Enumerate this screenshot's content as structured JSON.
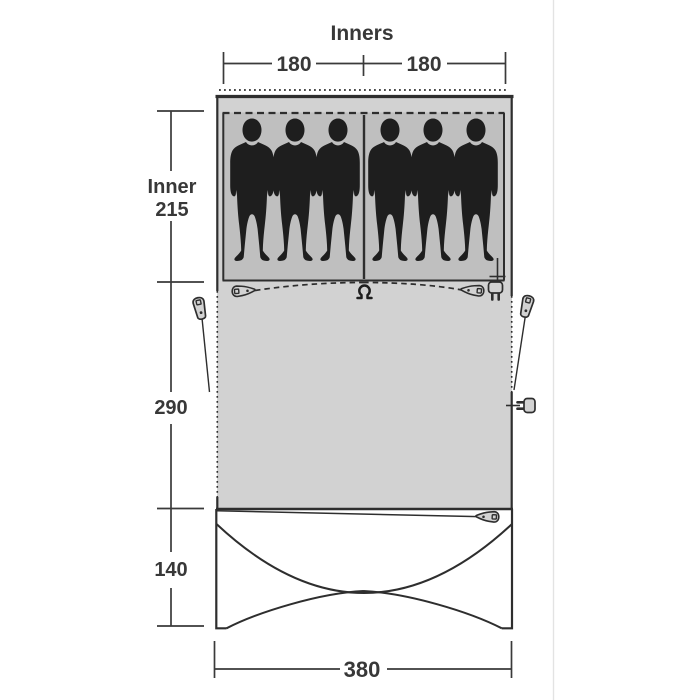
{
  "diagram": {
    "title": "Inners",
    "dimensions": {
      "inners_left": "180",
      "inners_right": "180",
      "inner_word": "Inner",
      "inner_depth": "215",
      "living_depth": "290",
      "canopy_depth": "140",
      "total_width": "380"
    },
    "rooms": {
      "inner_compartments": 2,
      "sleepers_per_compartment": 3,
      "total_sleepers": 6
    },
    "icons": {
      "person": "person-silhouette",
      "zipper": "zipper-pull",
      "hook": "lantern-hook",
      "plug": "power-plug-entry",
      "guyline": "guyline-peg"
    },
    "colors": {
      "tent_fill": "#d2d2d2",
      "inner_fill": "#bfbfbf",
      "outline": "#2e2e2e",
      "dimension_text": "#383838",
      "silhouette": "#1e1e1e",
      "page_divider": "#e3e3e3"
    }
  }
}
